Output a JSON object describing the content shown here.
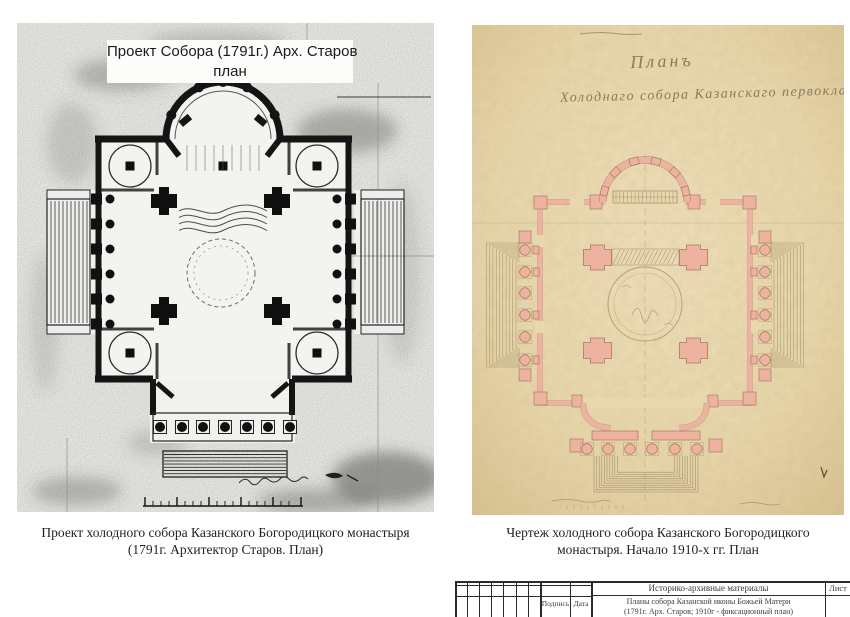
{
  "left_figure": {
    "label_line1": "Проект Собора (1791г.) Арх. Старов",
    "label_line2": "план",
    "caption_line1": "Проект холодного собора Казанского Богородицкого монастыря",
    "caption_line2": "(1791г. Архитектор Старов. План)"
  },
  "right_figure": {
    "handwritten_title": "Планъ",
    "handwritten_subtitle": "Холоднаго собора Казанскаго первокласснаго",
    "caption_line1": "Чертеж холодного собора Казанского Богородицкого",
    "caption_line2": "монастыря. Начало 1910-х гг. План"
  },
  "title_block": {
    "header": "Историко-архивные материалы",
    "description_line1": "Планы собора Казанской иконы Божьей Матери",
    "description_line2": "(1791г. Арх. Старов; 1910г - фиксационный план)",
    "signature_label": "Подпись",
    "date_label": "Дата",
    "sheet_label": "Лист"
  },
  "colors": {
    "left_scan_bg": "#e9e9e6",
    "right_paper": "#e9d8ae",
    "plan_pink": "#eeb2a1",
    "ink": "#141414"
  }
}
